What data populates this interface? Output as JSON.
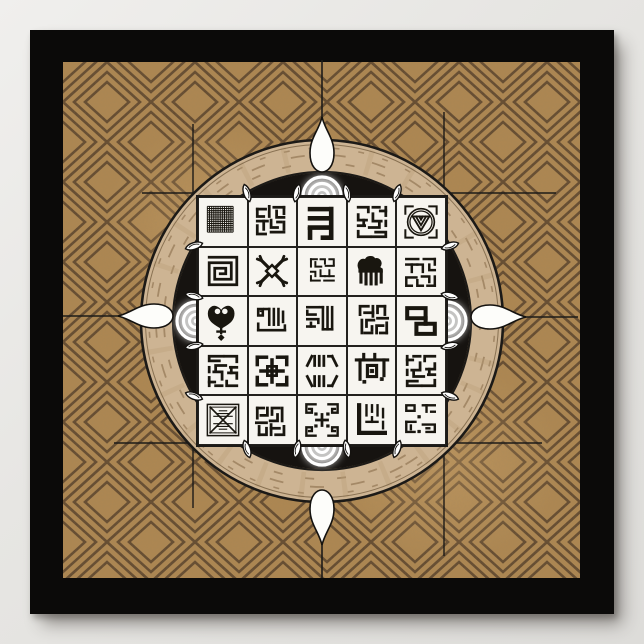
{
  "artwork": {
    "kind": "framed-poster",
    "motif": "african-symbol-medallion",
    "frame_color": "#0b0a09",
    "page_bg": "#e7e6e3"
  },
  "cloth": {
    "base": "#ae8751",
    "light_patch": "#c49d67",
    "line": "#59422a",
    "pattern": "diamond-lattice"
  },
  "medallion": {
    "ring": "#cdb493",
    "ring_streak": "#8a6d4b",
    "ring_grain": "#b79b74",
    "outline": "#1c1a17",
    "disc": "#161310",
    "glow": "#ffffff",
    "ornament_fill": "#fdfdfa",
    "leaf_fill": "#ffffff",
    "guide_line": "#1d1b18",
    "ornaments": [
      "gourd-north",
      "gourd-east",
      "gourd-south",
      "gourd-west"
    ],
    "leaf_marker_count": 16,
    "glow_targets": [
      "north",
      "east",
      "south",
      "west"
    ]
  },
  "grid": {
    "rows": 5,
    "cols": 5,
    "tile_fill": "#f7f5f0",
    "line_color": "#23211e",
    "glyph_color": "#19160f",
    "tiles": [
      {
        "name": "woven-mesh",
        "g": "mesh"
      },
      {
        "name": "kufic-square-dense",
        "g": "kufA"
      },
      {
        "name": "bold-meander",
        "g": "meander"
      },
      {
        "name": "kufic-square-script",
        "g": "kufB"
      },
      {
        "name": "shell-medallion",
        "g": "shell"
      },
      {
        "name": "labyrinth-maze",
        "g": "labyrinth"
      },
      {
        "name": "crossed-x-ornament",
        "g": "xbones"
      },
      {
        "name": "kufic-blocks-small",
        "g": "kufC",
        "t": "translate(5 5) scale(0.8)"
      },
      {
        "name": "duafe-comb",
        "g": "duafe"
      },
      {
        "name": "kufic-square-script2",
        "g": "kufC",
        "t": "rotate(180 25 25)"
      },
      {
        "name": "sankofa-heart",
        "g": "sankofa"
      },
      {
        "name": "kufic-allah-frame",
        "g": "allahFrame"
      },
      {
        "name": "kufic-split-columns",
        "g": "split"
      },
      {
        "name": "kufic-blocks-dotted",
        "g": "kufA",
        "t": "rotate(90 25 25)"
      },
      {
        "name": "chain-links",
        "g": "chain"
      },
      {
        "name": "kufic-square-rot",
        "g": "kufB",
        "t": "rotate(180 25 25)"
      },
      {
        "name": "bold-kufic-block",
        "g": "boldBlock"
      },
      {
        "name": "mirrored-strokes",
        "g": "mirror"
      },
      {
        "name": "table-square-glyph",
        "g": "erTable"
      },
      {
        "name": "kufic-square-flip",
        "g": "kufB",
        "t": "scale(-1 1) translate(-50 0)"
      },
      {
        "name": "envelope-cross",
        "g": "envelope"
      },
      {
        "name": "kufic-dense-rot",
        "g": "kufA",
        "t": "rotate(-90 25 25)"
      },
      {
        "name": "corner-spirals",
        "g": "spirals"
      },
      {
        "name": "l-frame-kufic",
        "g": "lframe"
      },
      {
        "name": "kufic-blocks-dots",
        "g": "blocksDots"
      }
    ]
  },
  "glyphs": {
    "mesh": {
      "type": "mesh"
    },
    "kufA": {
      "sw": 3,
      "paths": [
        {
          "d": "M9 11h9"
        },
        {
          "d": "M9 11v8h7"
        },
        {
          "d": "M22 8v11"
        },
        {
          "d": "M27 9h11"
        },
        {
          "d": "M38 9v7"
        },
        {
          "d": "M30 13v7h8"
        },
        {
          "d": "M9 24h11"
        },
        {
          "d": "M16 24v9"
        },
        {
          "d": "M9 29v9h9"
        },
        {
          "d": "M24 23v8h7"
        },
        {
          "d": "M24 36h14"
        },
        {
          "d": "M38 25v8"
        },
        {
          "d": "M31 25h4"
        }
      ]
    },
    "kufB": {
      "sw": 3,
      "paths": [
        {
          "d": "M10 9h11v5"
        },
        {
          "d": "M26 9h7"
        },
        {
          "d": "M40 9v9"
        },
        {
          "d": "M34 13h6"
        },
        {
          "d": "M10 17v6h9"
        },
        {
          "d": "M16 23v6"
        },
        {
          "d": "M26 16v8h9"
        },
        {
          "d": "M10 29h7"
        },
        {
          "d": "M22 31h11v-5"
        },
        {
          "d": "M10 35v6h13"
        },
        {
          "d": "M29 36h11v5h-15"
        },
        {
          "d": "M40 24v5"
        }
      ]
    },
    "kufC": {
      "sw": 2.7,
      "paths": [
        {
          "d": "M10 9h8"
        },
        {
          "d": "M23 9h6v6"
        },
        {
          "d": "M35 9h6v8"
        },
        {
          "d": "M10 9v10"
        },
        {
          "d": "M16 13v6h8"
        },
        {
          "d": "M30 18h11"
        },
        {
          "d": "M10 26h6v6"
        },
        {
          "d": "M23 24v8h6"
        },
        {
          "d": "M35 24v8"
        },
        {
          "d": "M29 32h12"
        },
        {
          "d": "M10 38h12"
        },
        {
          "d": "M28 38h13"
        },
        {
          "d": "M10 32v6"
        }
      ]
    },
    "meander": {
      "sw": 5,
      "paths": [
        {
          "d": "M12 11h23"
        },
        {
          "d": "M35 11v20"
        },
        {
          "d": "M12 21h23"
        },
        {
          "d": "M12 31h23"
        },
        {
          "d": "M12 33v9"
        },
        {
          "d": "M35 31v11h-9"
        }
      ]
    },
    "shell": {
      "sw": 2.2,
      "paths": [
        {
          "d": "M8 16V8h8"
        },
        {
          "d": "M34 8h8v8"
        },
        {
          "d": "M42 34v8h-8"
        },
        {
          "d": "M16 42H8v-8"
        },
        {
          "d": "M10.5 25a14.5 14.5 0 1 0 29 0a14.5 14.5 0 1 0 -29 0",
          "w": 1.8
        },
        {
          "d": "M13 25a12 12 0 1 0 24 0a12 12 0 1 0 -24 0",
          "w": 1.4
        },
        {
          "d": "M16 19h18",
          "w": 2
        },
        {
          "d": "M16 19l9 15 9-15",
          "w": 2
        },
        {
          "d": "M19.5 19l5.5 9.5L30.5 19",
          "w": 2
        },
        {
          "d": "M23 19l2 3.5 2-3.5",
          "w": 2
        }
      ]
    },
    "labyrinth": {
      "sw": 3,
      "paths": [
        {
          "d": "M10 10h30v30H10V16h24v18H16V22h12v6h-6"
        }
      ]
    },
    "xbones": {
      "sw": 3.6,
      "cap": "round",
      "paths": [
        {
          "d": "M14 14L36 36"
        },
        {
          "d": "M36 14L14 36"
        },
        {
          "d": "M14 14 9 12",
          "w": 3
        },
        {
          "d": "M14 14 12 9",
          "w": 3
        },
        {
          "d": "M36 14 41 12",
          "w": 3
        },
        {
          "d": "M36 14 38 9",
          "w": 3
        },
        {
          "d": "M14 36 9 38",
          "w": 3
        },
        {
          "d": "M14 36 12 41",
          "w": 3
        },
        {
          "d": "M36 36 41 38",
          "w": 3
        },
        {
          "d": "M36 36 38 41",
          "w": 3
        },
        {
          "d": "M25 18.5 31.5 25 25 31.5 18.5 25Z",
          "f": "#f7f5f0",
          "w": 2.6
        }
      ]
    },
    "duafe": {
      "sw": 3.4,
      "paths": [
        {
          "d": "M11 23c-3-7 2-12 7-10 1-4 8-5 10-1 5-2 9 4 5 9l3 2v3H11z",
          "f": "#19160f",
          "w": 1.5
        },
        {
          "d": "M13 26v11"
        },
        {
          "d": "M18.5 26v13"
        },
        {
          "d": "M24 26v13"
        },
        {
          "d": "M29.5 26v13"
        },
        {
          "d": "M35 26v11"
        }
      ]
    },
    "sankofa": {
      "sw": 2.6,
      "paths": [
        {
          "d": "M23 33C15 28 9 25 9 17c0-6 5-10 10-7 2 1 3 2 4 4 1-2 2-3 4-4 5-3 10 1 10 7 0 8-6 11-14 16z",
          "f": "#19160f",
          "w": 1
        },
        {
          "d": "M16 14.5a3 3 0 1 0 6 0a3 3 0 1 0 -6 0",
          "f": "#f7f5f0"
        },
        {
          "d": "M24 14.5a3 3 0 1 0 6 0a3 3 0 1 0 -6 0",
          "f": "#f7f5f0"
        },
        {
          "d": "M23 33v5"
        },
        {
          "d": "M19 36.5h8"
        },
        {
          "d": "M23 40l3 3-3 3-3-3z",
          "f": "#19160f",
          "w": 1
        }
      ]
    },
    "allahFrame": {
      "sw": 2.8,
      "paths": [
        {
          "d": "M10 35h29"
        },
        {
          "d": "M10 35v-7"
        },
        {
          "d": "M39 35v-5"
        },
        {
          "d": "M22 12v17"
        },
        {
          "d": "M27 12v17"
        },
        {
          "d": "M32 12v17"
        },
        {
          "d": "M37 15v11"
        },
        {
          "d": "M22 12h-5"
        },
        {
          "d": "M10 12h5v7h-5z"
        },
        {
          "d": "M12.5 14.5h2",
          "w": 1.6
        }
      ]
    },
    "split": {
      "sw": 2.8,
      "paths": [
        {
          "d": "M9 10h12"
        },
        {
          "d": "M9 14v4h9"
        },
        {
          "d": "M9 23h12v4"
        },
        {
          "d": "M9 31h8"
        },
        {
          "d": "M13 27v4"
        },
        {
          "d": "M26 10v24"
        },
        {
          "d": "M31 10v24"
        },
        {
          "d": "M36 10v24"
        },
        {
          "d": "M26 34h10"
        },
        {
          "d": "M26 10h-3"
        }
      ]
    },
    "chain": {
      "sw": 4.4,
      "paths": [
        {
          "d": "M10 11h20v11H10z"
        },
        {
          "d": "M20 28h20v11H20z"
        },
        {
          "d": "M30 22v6"
        }
      ]
    },
    "boldBlock": {
      "sw": 3.8,
      "paths": [
        {
          "d": "M9 10h10"
        },
        {
          "d": "M9 10v8"
        },
        {
          "d": "M41 10h-10"
        },
        {
          "d": "M41 10v8"
        },
        {
          "d": "M9 40h10"
        },
        {
          "d": "M9 40v-8"
        },
        {
          "d": "M41 40h-10"
        },
        {
          "d": "M41 40v-8"
        },
        {
          "d": "M25 13v24"
        },
        {
          "d": "M13 25h24"
        },
        {
          "d": "M20 20h10v10H20z",
          "w": 3
        }
      ]
    },
    "mirror": {
      "sw": 3,
      "paths": [
        {
          "d": "M9 19l5-10"
        },
        {
          "d": "M17 9v10"
        },
        {
          "d": "M22 9v10"
        },
        {
          "d": "M27 9v10"
        },
        {
          "d": "M41 19l-5-10"
        },
        {
          "d": "M32 9h4"
        },
        {
          "d": "M9 31l5 10"
        },
        {
          "d": "M17 41V31"
        },
        {
          "d": "M22 41V31"
        },
        {
          "d": "M27 41V31"
        },
        {
          "d": "M41 31l-5 10"
        },
        {
          "d": "M32 41h4"
        }
      ]
    },
    "erTable": {
      "sw": 3.4,
      "paths": [
        {
          "d": "M8 13h34"
        },
        {
          "d": "M16 7v6"
        },
        {
          "d": "M28 7v6"
        },
        {
          "d": "M12 13v21"
        },
        {
          "d": "M38 13v17"
        },
        {
          "d": "M20 19h10v12H20z"
        },
        {
          "d": "M23 23h4v4h-4z",
          "f": "#19160f",
          "w": 0.5
        },
        {
          "d": "M34 32h3.5v3.5H34z",
          "f": "#19160f",
          "w": 0.5
        },
        {
          "d": "M15 35h3.5v3.5H15z",
          "f": "#19160f",
          "w": 0.5
        }
      ]
    },
    "envelope": {
      "sw": 1.6,
      "paths": [
        {
          "d": "M8 8h34v34H8z"
        },
        {
          "d": "M11 11h28v28H11z",
          "w": 1.2
        },
        {
          "d": "M11 11 39 39",
          "w": 1.8
        },
        {
          "d": "M39 11 11 39",
          "w": 1.8
        },
        {
          "d": "M21 15h8",
          "w": 1.2
        },
        {
          "d": "M18 18h14",
          "w": 1.2
        },
        {
          "d": "M15 21h20",
          "w": 1.2
        },
        {
          "d": "M15 29h20",
          "w": 1.2
        },
        {
          "d": "M18 32h14",
          "w": 1.2
        },
        {
          "d": "M21 35h8",
          "w": 1.2
        }
      ]
    },
    "spirals": {
      "sw": 2.6,
      "paths": [
        {
          "d": "M18 8H8v9h6v-4h-3"
        },
        {
          "d": "M32 8h10v9h-6v-4h3"
        },
        {
          "d": "M18 42H8v-9h6v4h-3"
        },
        {
          "d": "M32 42h10v-9h-6v4h3"
        },
        {
          "d": "M25 19v12",
          "w": 3
        },
        {
          "d": "M19 25h12",
          "w": 3
        },
        {
          "d": "M17 17h3v3h-3z",
          "f": "#19160f",
          "w": 0.5
        },
        {
          "d": "M30 17h3v3h-3z",
          "f": "#19160f",
          "w": 0.5
        },
        {
          "d": "M17 30h3v3h-3z",
          "f": "#19160f",
          "w": 0.5
        },
        {
          "d": "M30 30h3v3h-3z",
          "f": "#19160f",
          "w": 0.5
        }
      ]
    },
    "lframe": {
      "sw": 2.6,
      "paths": [
        {
          "d": "M11 9v30h28",
          "w": 4.6
        },
        {
          "d": "M19 9v11"
        },
        {
          "d": "M25 9v7"
        },
        {
          "d": "M31 9v11"
        },
        {
          "d": "M37 13v9"
        },
        {
          "d": "M19 27h12"
        },
        {
          "d": "M37 27v7"
        },
        {
          "d": "M25 22v5"
        }
      ]
    },
    "blocksDots": {
      "sw": 2.6,
      "paths": [
        {
          "d": "M9 9h9v6H9z"
        },
        {
          "d": "M27 9h13"
        },
        {
          "d": "M31 9v7"
        },
        {
          "d": "M36 16h4"
        },
        {
          "d": "M9 27h10"
        },
        {
          "d": "M9 27v11h9"
        },
        {
          "d": "M14 31v4"
        },
        {
          "d": "M27 30h13v8h-9"
        },
        {
          "d": "M31 34h3"
        },
        {
          "d": "M21.5 20h3v3h-3z",
          "f": "#19160f",
          "w": 0.5
        },
        {
          "d": "M21.5 36h3v3h-3z",
          "f": "#19160f",
          "w": 0.5
        }
      ]
    }
  }
}
